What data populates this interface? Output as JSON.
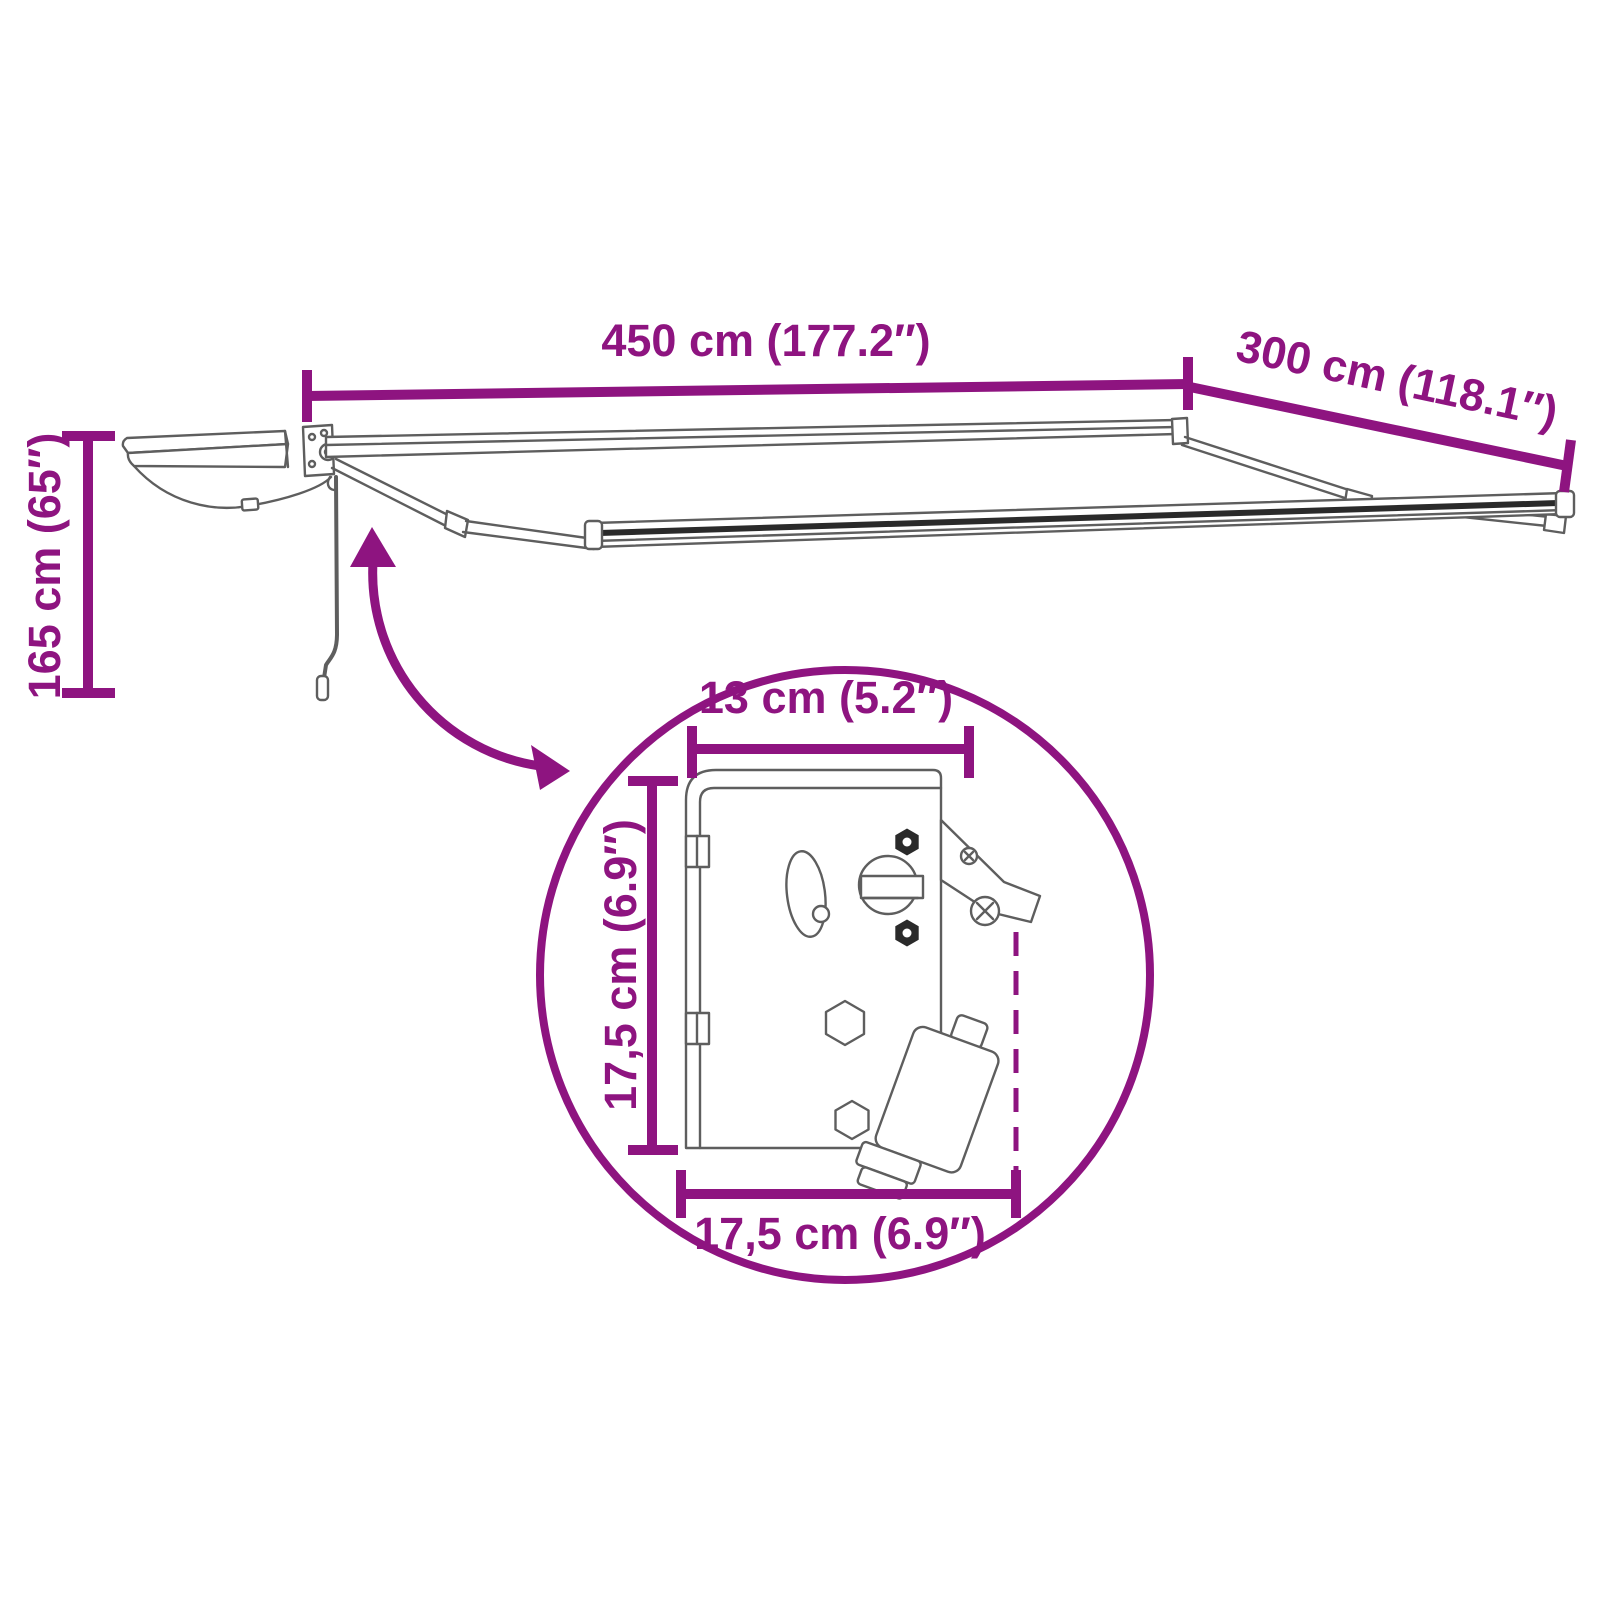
{
  "page": {
    "description": "Retractable awning dimension diagram with zoom detail of mounting bracket"
  },
  "colors": {
    "accent": "#8E1480",
    "line_art": "#5E5E5E",
    "dark": "#2A2A2A",
    "bg": "#FFFFFF"
  },
  "dimensions": {
    "width": {
      "label": "450 cm (177.2″)"
    },
    "projection": {
      "label": "300 cm (118.1″)"
    },
    "height": {
      "label": "165 cm (65″)"
    },
    "detail_top_width": {
      "label": "13 cm (5.2″)"
    },
    "detail_side_height": {
      "label": "17,5 cm (6.9″)"
    },
    "detail_bottom_width": {
      "label": "17,5 cm (6.9″)"
    }
  }
}
